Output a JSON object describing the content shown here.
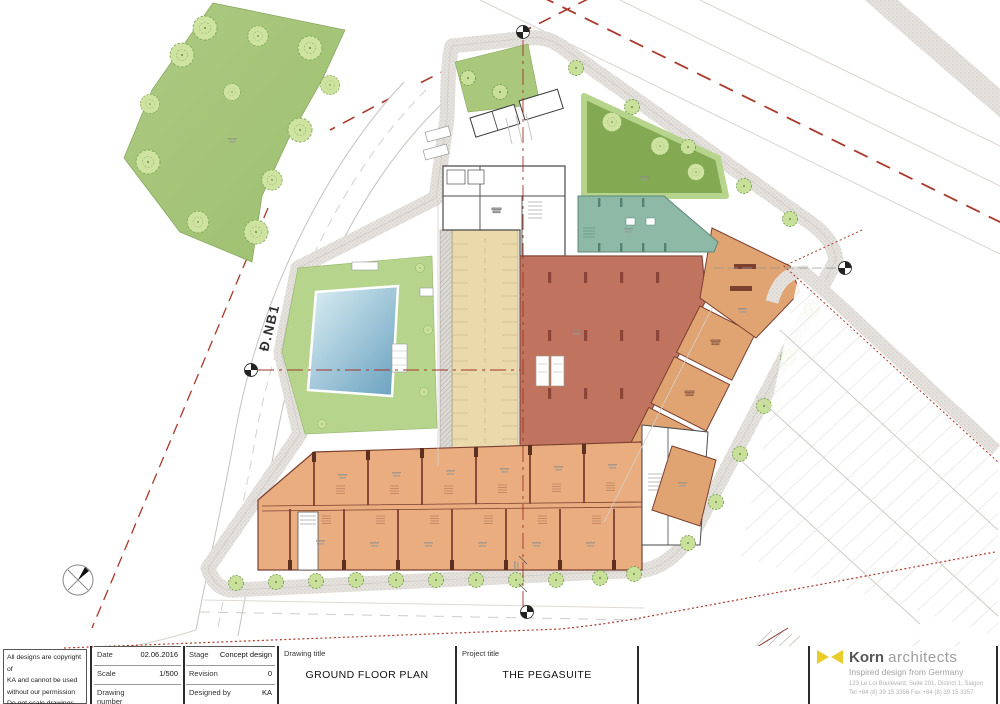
{
  "plan": {
    "road_label": "Đ.NB1",
    "colors": {
      "park_green": "#a9c87c",
      "lawn_dark_green": "#83aa52",
      "pool_surround_green": "#b6d48c",
      "pool_water_light": "#dceff4",
      "pool_water_dark": "#68a0bf",
      "retail_terracotta": "#c0735f",
      "shop_orange": "#dfa471",
      "townhouse_salmon": "#e9ad80",
      "wall_brown": "#7c4030",
      "terrace_teal": "#8db9a6",
      "parking_beige": "#ead9ab",
      "sidewalk_gray": "#e6e3df",
      "boundary_red": "#a8392b",
      "grid_line_red": "#a03428"
    }
  },
  "title_block": {
    "copyright_lines": [
      "All designs are copyright of",
      "KA and cannot be used",
      "without our permission",
      "Do not scale drawings."
    ],
    "date_section": {
      "rows": [
        {
          "label": "Date",
          "value": "02.06.2016"
        },
        {
          "label": "Scale",
          "value": "1/500"
        },
        {
          "label": "Drawing number",
          "value": ""
        }
      ]
    },
    "stage_section": {
      "rows": [
        {
          "label": "Stage",
          "value": "Concept design"
        },
        {
          "label": "Revision",
          "value": "0"
        },
        {
          "label": "Designed by",
          "value": "KA"
        }
      ]
    },
    "drawing_title": {
      "label": "Drawing title",
      "value": "GROUND FLOOR PLAN"
    },
    "project_title": {
      "label": "Project title",
      "value": "THE PEGASUITE"
    }
  },
  "logo": {
    "name_bold": "Korn",
    "name_light": "architects",
    "tagline": "Inspired design from Germany",
    "address_line1": "123 Le Loi Boulevard, Suite 201, District 1, Saigon",
    "address_line2": "Tel +84 (8) 39 15 3356   Fax +84 (8) 39 15 3357",
    "icon_color": "#e8cc2b"
  }
}
